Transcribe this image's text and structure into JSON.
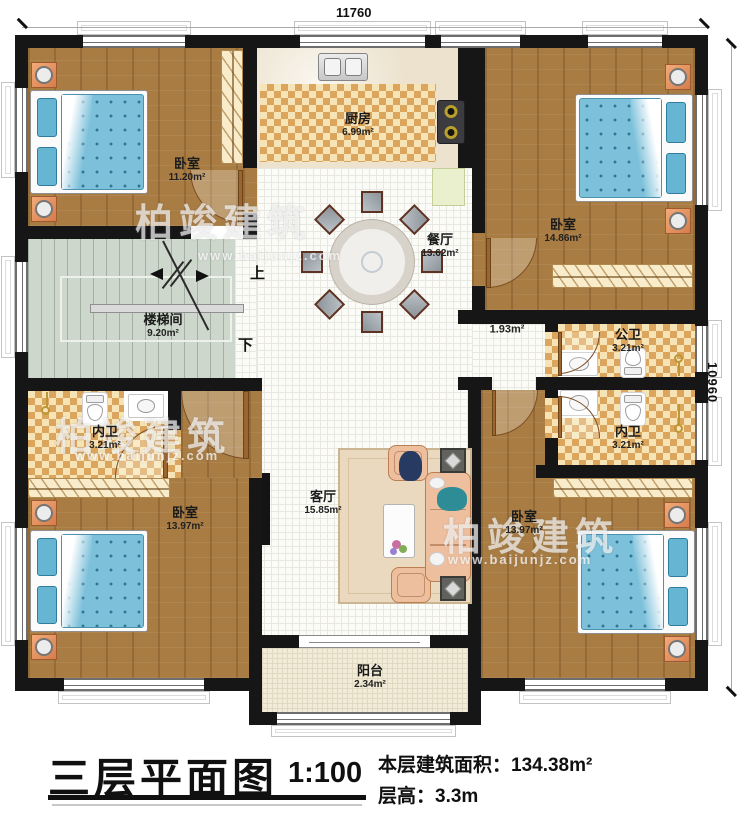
{
  "plan": {
    "dimensions": {
      "width_top": "11760",
      "height_right": "10960"
    },
    "rooms": {
      "bedroom_tl": {
        "name": "卧室",
        "area": "11.20m²"
      },
      "kitchen": {
        "name": "厨房",
        "area": "6.99m²"
      },
      "bedroom_tr": {
        "name": "卧室",
        "area": "14.86m²"
      },
      "dining": {
        "name": "餐厅",
        "area": "13.62m²"
      },
      "stairwell": {
        "name": "楼梯间",
        "area": "9.20m²"
      },
      "hallway": {
        "area": "1.93m²"
      },
      "bath_public": {
        "name": "公卫",
        "area": "3.21m²"
      },
      "bath_ensuite_right": {
        "name": "内卫",
        "area": "3.21m²"
      },
      "bath_ensuite_left": {
        "name": "内卫",
        "area": "3.21m²"
      },
      "bedroom_bl": {
        "name": "卧室",
        "area": "13.97m²"
      },
      "living": {
        "name": "客厅",
        "area": "15.85m²"
      },
      "bedroom_br": {
        "name": "卧室",
        "area": "13.97m²"
      },
      "balcony": {
        "name": "阳台",
        "area": "2.34m²"
      }
    },
    "stairs": {
      "up_label": "上",
      "down_label": "下"
    }
  },
  "titleblock": {
    "title": "三层平面图",
    "scale": "1:100",
    "area_label": "本层建筑面积：",
    "area_value": "134.38m²",
    "floor_height_label": "层高：",
    "floor_height_value": "3.3m"
  },
  "watermark": {
    "brand": "柏竣建筑",
    "url": "www.baijunjz.com"
  }
}
